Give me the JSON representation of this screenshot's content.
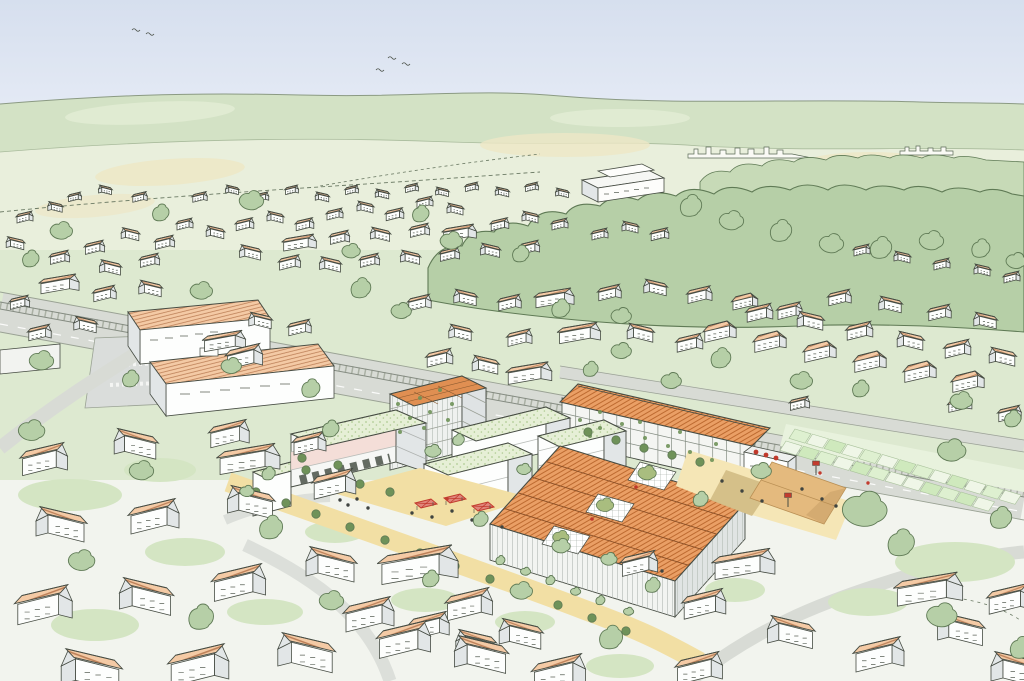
{
  "meta": {
    "title": "Hand-drawn aerial perspective illustration of a town with a proposed mixed-use development (white blocks with green roofs, a timber residential slab with orange roof, and a large production hall with sawtooth orange roofs) between an existing village, a railway corridor, allotment gardens and wooded hills"
  },
  "palette": {
    "ink": "#464c43",
    "paper": "#fbfcf8",
    "sky-top": "#d6dfee",
    "sky": "#e4eaf5",
    "horizon-line": "#8b9a83",
    "hill": "#d3e2c5",
    "hill-line": "#a9bb9c",
    "fields": "#e9efdc",
    "field-yellow": "#ede7c6",
    "grass-mid": "#dde9d0",
    "fore-paper": "#f2f4ee",
    "garden": "#d4e5c3",
    "forest": "#b6cfa7",
    "forest-light": "#c7dab7",
    "tree-outline": "#5f7a55",
    "street-tree": "#6f9259",
    "roof-salmon": "#f4caa5",
    "roof-hatch": "#bd8058",
    "roof-orange": "#ea9f65",
    "roof-orange-dark": "#bd6a30",
    "green-roof": "#e6efd6",
    "green-roof-dot": "#b0cb93",
    "pv-roof": "#e08f52",
    "wall": "#fdfefd",
    "wall-shade": "#e2e6e7",
    "accent-pink": "#f3d9d2",
    "road": "#d8dbd5",
    "road-edge": "#9aa294",
    "rail": "#848b81",
    "plaza": "#f2dfa4",
    "plaza-light": "#f5e6b6",
    "court": "#e4ba7e",
    "court-dark": "#c79f66",
    "khaki": "#cdb77e",
    "stall-red": "#c23b2e",
    "stall-fill": "#e0857a",
    "allot-1": "#def0d0",
    "allot-2": "#eff6e7",
    "allot-3": "#cfe9bd",
    "allot-edge": "#a9c29b",
    "people": "#3f4440"
  },
  "scene": {
    "houses_far": [
      [
        200,
        196,
        0.45,
        0
      ],
      [
        232,
        189,
        0.4,
        1
      ],
      [
        262,
        196,
        0.42,
        0
      ],
      [
        292,
        189,
        0.4,
        0
      ],
      [
        322,
        196,
        0.42,
        1
      ],
      [
        352,
        189,
        0.4,
        0
      ],
      [
        382,
        193,
        0.42,
        1
      ],
      [
        412,
        187,
        0.4,
        0
      ],
      [
        442,
        191,
        0.4,
        1
      ],
      [
        472,
        186,
        0.4,
        0
      ],
      [
        502,
        191,
        0.42,
        1
      ],
      [
        532,
        186,
        0.4,
        0
      ],
      [
        562,
        192,
        0.4,
        1
      ],
      [
        75,
        196,
        0.4,
        0
      ],
      [
        105,
        189,
        0.4,
        1
      ],
      [
        140,
        196,
        0.45,
        0
      ],
      [
        95,
        246,
        0.6,
        0
      ],
      [
        130,
        233,
        0.55,
        1
      ],
      [
        165,
        241,
        0.6,
        0
      ],
      [
        150,
        259,
        0.6,
        0
      ],
      [
        110,
        266,
        0.65,
        1
      ],
      [
        185,
        223,
        0.5,
        0
      ],
      [
        215,
        231,
        0.55,
        1
      ],
      [
        245,
        223,
        0.55,
        0
      ],
      [
        275,
        216,
        0.5,
        1
      ],
      [
        305,
        223,
        0.55,
        0
      ],
      [
        335,
        213,
        0.5,
        0
      ],
      [
        365,
        206,
        0.5,
        1
      ],
      [
        395,
        213,
        0.55,
        0
      ],
      [
        425,
        201,
        0.5,
        0
      ],
      [
        455,
        208,
        0.5,
        1
      ],
      [
        300,
        241,
        0.6,
        2
      ],
      [
        340,
        236,
        0.6,
        0
      ],
      [
        380,
        233,
        0.6,
        1
      ],
      [
        420,
        229,
        0.6,
        0
      ],
      [
        460,
        231,
        0.6,
        2
      ],
      [
        500,
        223,
        0.55,
        0
      ],
      [
        530,
        216,
        0.5,
        1
      ],
      [
        560,
        223,
        0.5,
        0
      ],
      [
        250,
        251,
        0.65,
        1
      ],
      [
        290,
        261,
        0.65,
        0
      ],
      [
        330,
        263,
        0.65,
        1
      ],
      [
        370,
        259,
        0.6,
        0
      ],
      [
        410,
        256,
        0.6,
        1
      ],
      [
        450,
        253,
        0.6,
        0
      ],
      [
        490,
        249,
        0.6,
        1
      ],
      [
        530,
        246,
        0.6,
        0
      ],
      [
        25,
        216,
        0.5,
        0
      ],
      [
        55,
        206,
        0.45,
        1
      ],
      [
        15,
        242,
        0.55,
        1
      ],
      [
        60,
        256,
        0.6,
        0
      ],
      [
        600,
        233,
        0.5,
        0
      ],
      [
        630,
        226,
        0.5,
        1
      ],
      [
        660,
        233,
        0.55,
        0
      ],
      [
        862,
        249,
        0.5,
        0
      ],
      [
        902,
        256,
        0.5,
        1
      ],
      [
        942,
        263,
        0.5,
        0
      ],
      [
        982,
        269,
        0.5,
        1
      ],
      [
        1012,
        276,
        0.5,
        0
      ],
      [
        60,
        282,
        0.7,
        2
      ],
      [
        105,
        292,
        0.7,
        0
      ],
      [
        150,
        287,
        0.7,
        1
      ],
      [
        420,
        301,
        0.7,
        0
      ],
      [
        465,
        296,
        0.7,
        1
      ],
      [
        510,
        301,
        0.7,
        0
      ],
      [
        555,
        296,
        0.7,
        2
      ],
      [
        610,
        291,
        0.7,
        0
      ],
      [
        655,
        286,
        0.7,
        1
      ],
      [
        700,
        293,
        0.75,
        0
      ],
      [
        745,
        301,
        0.75,
        3
      ],
      [
        790,
        309,
        0.75,
        0
      ],
      [
        640,
        331,
        0.8,
        1
      ],
      [
        690,
        341,
        0.8,
        0
      ],
      [
        580,
        331,
        0.75,
        2
      ],
      [
        520,
        336,
        0.75,
        0
      ],
      [
        460,
        331,
        0.7,
        1
      ],
      [
        720,
        331,
        0.95,
        3
      ],
      [
        770,
        341,
        0.95,
        3
      ],
      [
        820,
        351,
        0.95,
        3
      ],
      [
        870,
        361,
        0.95,
        3
      ],
      [
        920,
        371,
        0.95,
        3
      ],
      [
        968,
        381,
        0.95,
        3
      ],
      [
        760,
        311,
        0.8,
        0
      ],
      [
        810,
        319,
        0.8,
        1
      ],
      [
        860,
        329,
        0.8,
        0
      ],
      [
        910,
        339,
        0.8,
        1
      ],
      [
        958,
        347,
        0.8,
        0
      ],
      [
        1002,
        355,
        0.8,
        1
      ],
      [
        840,
        296,
        0.7,
        0
      ],
      [
        890,
        303,
        0.7,
        1
      ],
      [
        940,
        311,
        0.7,
        0
      ],
      [
        985,
        319,
        0.7,
        1
      ],
      [
        40,
        331,
        0.7,
        0
      ],
      [
        85,
        323,
        0.7,
        1
      ],
      [
        20,
        301,
        0.6,
        0
      ],
      [
        260,
        319,
        0.7,
        1
      ],
      [
        300,
        326,
        0.7,
        0
      ],
      [
        225,
        339,
        0.75,
        2
      ],
      [
        245,
        354,
        1.1,
        0
      ],
      [
        440,
        356,
        0.8,
        0
      ],
      [
        485,
        363,
        0.8,
        1
      ],
      [
        530,
        371,
        0.8,
        2
      ],
      [
        800,
        402,
        0.6,
        0
      ],
      [
        960,
        404,
        0.7,
        3
      ],
      [
        1010,
        412,
        0.7,
        0
      ]
    ],
    "houses_near": [
      [
        250,
        456,
        1.1,
        2
      ],
      [
        310,
        441,
        1.0,
        0
      ],
      [
        45,
        456,
        1.4,
        0
      ],
      [
        135,
        441,
        1.3,
        1
      ],
      [
        230,
        431,
        1.2,
        0
      ],
      [
        335,
        481,
        1.3,
        0
      ],
      [
        60,
        521,
        1.5,
        1
      ],
      [
        155,
        513,
        1.5,
        0
      ],
      [
        250,
        499,
        1.4,
        1
      ],
      [
        420,
        561,
        1.4,
        2
      ],
      [
        45,
        601,
        1.7,
        0
      ],
      [
        145,
        593,
        1.6,
        1
      ],
      [
        240,
        579,
        1.6,
        0
      ],
      [
        330,
        561,
        1.5,
        1
      ],
      [
        370,
        611,
        1.5,
        0
      ],
      [
        470,
        601,
        1.4,
        0
      ],
      [
        430,
        623,
        1.2,
        0
      ],
      [
        475,
        641,
        1.2,
        1
      ],
      [
        520,
        631,
        1.3,
        1
      ],
      [
        90,
        666,
        1.8,
        1
      ],
      [
        200,
        661,
        1.8,
        0
      ],
      [
        305,
        649,
        1.7,
        1
      ],
      [
        405,
        636,
        1.6,
        0
      ],
      [
        480,
        651,
        1.6,
        1
      ],
      [
        560,
        669,
        1.6,
        0
      ],
      [
        640,
        561,
        1.1,
        0
      ],
      [
        745,
        561,
        1.1,
        2
      ],
      [
        705,
        601,
        1.3,
        0
      ],
      [
        790,
        629,
        1.4,
        1
      ],
      [
        880,
        651,
        1.5,
        0
      ],
      [
        960,
        626,
        1.4,
        1
      ],
      [
        1010,
        596,
        1.3,
        0
      ],
      [
        930,
        586,
        1.2,
        2
      ],
      [
        1015,
        666,
        1.5,
        1
      ],
      [
        700,
        665,
        1.4,
        0
      ]
    ],
    "trees_far": [
      [
        250,
        202,
        1.2
      ],
      [
        160,
        216,
        1.0
      ],
      [
        60,
        232,
        1.1
      ],
      [
        30,
        262,
        1.0
      ],
      [
        350,
        252,
        0.9
      ],
      [
        420,
        217,
        1.0
      ],
      [
        450,
        242,
        1.1
      ],
      [
        520,
        257,
        1.0
      ],
      [
        200,
        292,
        1.1
      ],
      [
        360,
        292,
        1.2
      ],
      [
        400,
        312,
        1.0
      ],
      [
        560,
        312,
        1.1
      ],
      [
        620,
        317,
        1.0
      ],
      [
        690,
        210,
        1.3
      ],
      [
        730,
        222,
        1.2
      ],
      [
        780,
        235,
        1.3
      ],
      [
        830,
        245,
        1.2
      ],
      [
        880,
        252,
        1.3
      ],
      [
        930,
        242,
        1.2
      ],
      [
        980,
        252,
        1.1
      ],
      [
        1015,
        262,
        1.0
      ],
      [
        720,
        362,
        1.2
      ],
      [
        800,
        382,
        1.1
      ],
      [
        860,
        392,
        1.0
      ],
      [
        960,
        402,
        1.1
      ],
      [
        1012,
        422,
        1.0
      ],
      [
        40,
        362,
        1.2
      ],
      [
        130,
        382,
        1.0
      ],
      [
        230,
        367,
        1.0
      ],
      [
        310,
        392,
        1.1
      ],
      [
        620,
        352,
        1.0
      ],
      [
        590,
        372,
        0.9
      ],
      [
        670,
        382,
        1.0
      ]
    ],
    "trees_near": [
      [
        30,
        432,
        1.3
      ],
      [
        330,
        432,
        1.0
      ],
      [
        140,
        472,
        1.2
      ],
      [
        270,
        532,
        1.4
      ],
      [
        80,
        562,
        1.3
      ],
      [
        200,
        622,
        1.5
      ],
      [
        330,
        602,
        1.2
      ],
      [
        430,
        582,
        1.0
      ],
      [
        520,
        592,
        1.1
      ],
      [
        610,
        642,
        1.4
      ],
      [
        862,
        512,
        2.2
      ],
      [
        900,
        548,
        1.6
      ],
      [
        950,
        452,
        1.4
      ],
      [
        1000,
        522,
        1.3
      ],
      [
        760,
        472,
        1.0
      ],
      [
        700,
        502,
        0.9
      ],
      [
        560,
        547,
        0.9
      ],
      [
        480,
        522,
        0.9
      ],
      [
        940,
        617,
        1.5
      ],
      [
        1020,
        652,
        1.3
      ],
      [
        608,
        560,
        0.8
      ],
      [
        652,
        588,
        0.9
      ],
      [
        432,
        452,
        0.8
      ],
      [
        458,
        442,
        0.7
      ],
      [
        523,
        470,
        0.7
      ],
      [
        268,
        476,
        0.8
      ],
      [
        246,
        492,
        0.7
      ],
      [
        500,
        562,
        0.55
      ],
      [
        525,
        572,
        0.5
      ],
      [
        550,
        582,
        0.55
      ],
      [
        575,
        592,
        0.5
      ],
      [
        600,
        602,
        0.55
      ],
      [
        628,
        612,
        0.5
      ]
    ],
    "street_trees": [
      [
        256,
        492
      ],
      [
        286,
        503
      ],
      [
        316,
        514
      ],
      [
        350,
        527
      ],
      [
        385,
        540
      ],
      [
        420,
        553
      ],
      [
        455,
        566
      ],
      [
        490,
        579
      ],
      [
        524,
        592
      ],
      [
        558,
        605
      ],
      [
        592,
        618
      ],
      [
        626,
        631
      ],
      [
        306,
        470
      ],
      [
        332,
        477
      ],
      [
        360,
        484
      ],
      [
        390,
        492
      ],
      [
        302,
        458
      ],
      [
        338,
        465
      ],
      [
        588,
        432
      ],
      [
        616,
        440
      ],
      [
        644,
        448
      ],
      [
        672,
        455
      ],
      [
        700,
        462
      ]
    ],
    "people": [
      [
        340,
        500,
        0
      ],
      [
        348,
        505,
        0
      ],
      [
        357,
        499,
        0
      ],
      [
        368,
        508,
        0
      ],
      [
        412,
        513,
        0
      ],
      [
        432,
        517,
        0
      ],
      [
        452,
        511,
        0
      ],
      [
        472,
        520,
        0
      ],
      [
        502,
        527,
        0
      ],
      [
        722,
        481,
        0
      ],
      [
        742,
        491,
        0
      ],
      [
        762,
        501,
        0
      ],
      [
        802,
        489,
        0
      ],
      [
        822,
        499,
        0
      ],
      [
        836,
        506,
        0
      ],
      [
        642,
        561,
        0
      ],
      [
        662,
        571,
        0
      ],
      [
        447,
        499,
        1
      ],
      [
        820,
        473,
        1
      ],
      [
        868,
        483,
        1
      ],
      [
        755,
        470,
        1
      ]
    ],
    "stalls": [
      [
        415,
        503
      ],
      [
        444,
        498
      ],
      [
        472,
        506
      ]
    ],
    "hoops": [
      [
        816,
        470
      ],
      [
        788,
        502
      ]
    ],
    "allotment_rows": [
      {
        "x": 795,
        "y": 429,
        "dx": 17.5,
        "dy": 5.1,
        "cols": 13,
        "colors": [
          1,
          2,
          3,
          2,
          1,
          2,
          3,
          1,
          2,
          3,
          2,
          1,
          2
        ]
      },
      {
        "x": 786,
        "y": 441,
        "dx": 17.5,
        "dy": 5.1,
        "cols": 12,
        "colors": [
          2,
          3,
          1,
          2,
          3,
          1,
          2,
          2,
          3,
          1,
          3,
          2
        ]
      }
    ],
    "facade_plants": [
      [
        580,
        420
      ],
      [
        600,
        428
      ],
      [
        622,
        424
      ],
      [
        645,
        438
      ],
      [
        668,
        446
      ],
      [
        690,
        452
      ],
      [
        712,
        460
      ],
      [
        600,
        412
      ],
      [
        640,
        422
      ],
      [
        680,
        432
      ],
      [
        716,
        444
      ],
      [
        590,
        436
      ],
      [
        398,
        404
      ],
      [
        420,
        398
      ],
      [
        440,
        390
      ],
      [
        410,
        418
      ],
      [
        430,
        412
      ],
      [
        452,
        404
      ],
      [
        400,
        432
      ],
      [
        424,
        428
      ],
      [
        448,
        420
      ]
    ],
    "garden_patches": [
      [
        70,
        495,
        52,
        16
      ],
      [
        185,
        552,
        40,
        14
      ],
      [
        95,
        625,
        44,
        16
      ],
      [
        265,
        612,
        38,
        13
      ],
      [
        425,
        600,
        34,
        12
      ],
      [
        335,
        532,
        30,
        11
      ],
      [
        525,
        622,
        30,
        11
      ],
      [
        620,
        666,
        34,
        12
      ],
      [
        955,
        562,
        60,
        20
      ],
      [
        868,
        602,
        40,
        14
      ],
      [
        735,
        590,
        30,
        12
      ],
      [
        160,
        470,
        36,
        12
      ]
    ],
    "birds": [
      [
        388,
        58
      ],
      [
        402,
        64
      ],
      [
        376,
        70
      ],
      [
        132,
        30
      ],
      [
        146,
        34
      ]
    ],
    "grazing_animals": [
      [
        798,
        230
      ],
      [
        805,
        231
      ]
    ]
  }
}
